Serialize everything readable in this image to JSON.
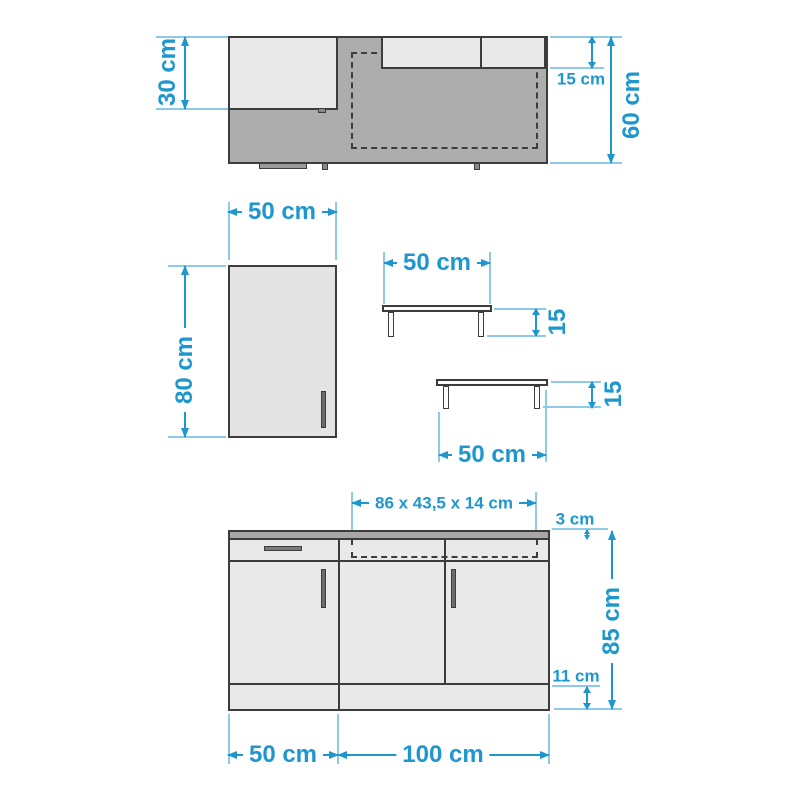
{
  "diagram": {
    "title_hint": "kitchen unit dimension drawing",
    "plan_view": {
      "dim_left": "30 cm",
      "dim_shelf_depth": "15 cm",
      "dim_depth": "60 cm"
    },
    "wall_cabinet": {
      "dim_width": "50 cm",
      "dim_height": "80 cm"
    },
    "shelf_upper": {
      "dim_width": "50 cm",
      "dim_height": "15"
    },
    "shelf_lower": {
      "dim_width": "50 cm",
      "dim_height": "15"
    },
    "base_unit": {
      "dim_appliance": "86 x 43,5 x 14 cm",
      "dim_worktop": "3 cm",
      "dim_height": "85 cm",
      "dim_plinth": "11 cm",
      "dim_left_width": "50 cm",
      "dim_right_width": "100 cm"
    },
    "colors": {
      "dimension_blue": "#1E97CF",
      "extension_blue": "#8FC9E8",
      "outline_gray": "#3C3C3C",
      "surface_dark_gray": "#ADADAD",
      "surface_light_gray": "#E9E9E9"
    }
  }
}
